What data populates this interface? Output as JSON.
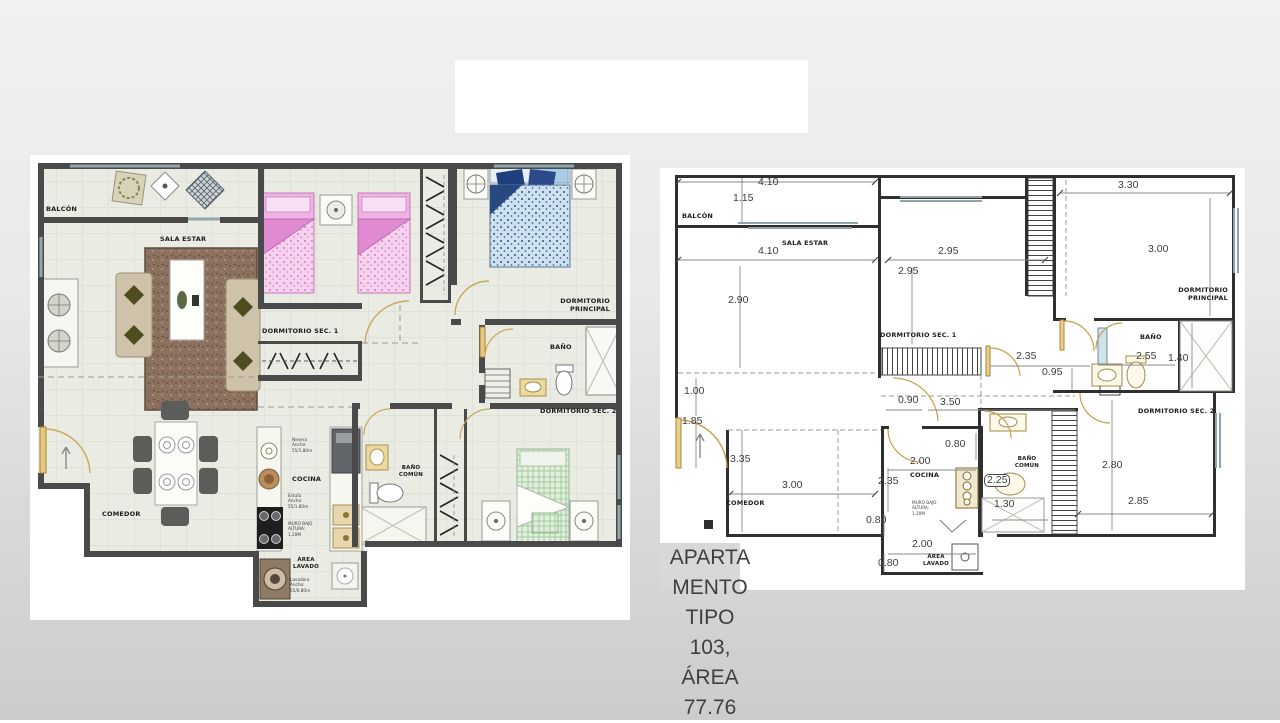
{
  "slide": {
    "caption": "APARTA\nMENTO\nTIPO\n103,\nÁREA\n77.76",
    "colors": {
      "slide_bg": "#e9e9e9",
      "wall": "#4a4a4a",
      "bed_pink": "#f2c4ea",
      "bed_blue": "#bdd7e8",
      "bed_green": "#cfe2c8",
      "rug_brown": "#8a7058",
      "door_tan": "#e2c277",
      "window_blue": "#92a7ae"
    }
  },
  "left_plan": {
    "labels": {
      "balcon": "BALCÓN",
      "sala_estar": "SALA ESTAR",
      "dormitorio_sec_1": "DORMITORIO SEC. 1",
      "dormitorio_principal": "DORMITORIO\nPRINCIPAL",
      "bano": "BAÑO",
      "dormitorio_sec_2": "DORMITORIO SEC. 2",
      "bano_comun": "BAÑO\nCOMÚN",
      "comedor": "COMEDOR",
      "cocina": "COCINA",
      "muro_bajo": "MURO BAJO\nALTURA:\n1.20M",
      "area_lavado": "ÁREA\nLAVADO",
      "nevera": "Nevera\nAncho:\n55/1.80m",
      "estufa": "Estufa\nAncho:\n55/1.80m",
      "lavadora": "Lavadora\nAncho:\n55/0.80m"
    }
  },
  "right_plan": {
    "labels": {
      "balcon": "BALCÓN",
      "sala_estar": "SALA ESTAR",
      "dormitorio_sec_1": "DORMITORIO SEC. 1",
      "dormitorio_principal": "DORMITORIO\nPRINCIPAL",
      "bano": "BAÑO",
      "dormitorio_sec_2": "DORMITORIO SEC. 2",
      "bano_comun": "BAÑO\nCOMÚN",
      "comedor": "COMEDOR",
      "cocina": "COCINA",
      "muro_bajo": "MURO BAJO\nALTURA:\n1.20M",
      "area_lavado": "ÁREA\nLAVADO"
    },
    "dims": {
      "balcon_w": "4.10",
      "balcon_d": "1.15",
      "sala_w": "4.10",
      "sala_d": "2.90",
      "sec1_w": "2.95",
      "sec1_d": "2.95",
      "principal_w": "3.30",
      "principal_d": "3.00",
      "pasillo_a": "2.35",
      "pasillo_b": "0.95",
      "bano_w": "2.55",
      "bano_d": "1.40",
      "acceso_a": "1.00",
      "acceso_b": "1.85",
      "comedor_d": "3.35",
      "comedor_w": "3.00",
      "cocina_a": "0.90",
      "cocina_b": "3.50",
      "cocina_c": "0.80",
      "cocina_w": "2.00",
      "cocina_d": "2.35",
      "muro_d": "0.80",
      "lavado_w": "2.00",
      "lavado_d": "0.80",
      "bano_comun_w": "2.25",
      "bano_comun_d": "1.30",
      "sec2_d": "2.80",
      "sec2_w": "2.85"
    }
  }
}
